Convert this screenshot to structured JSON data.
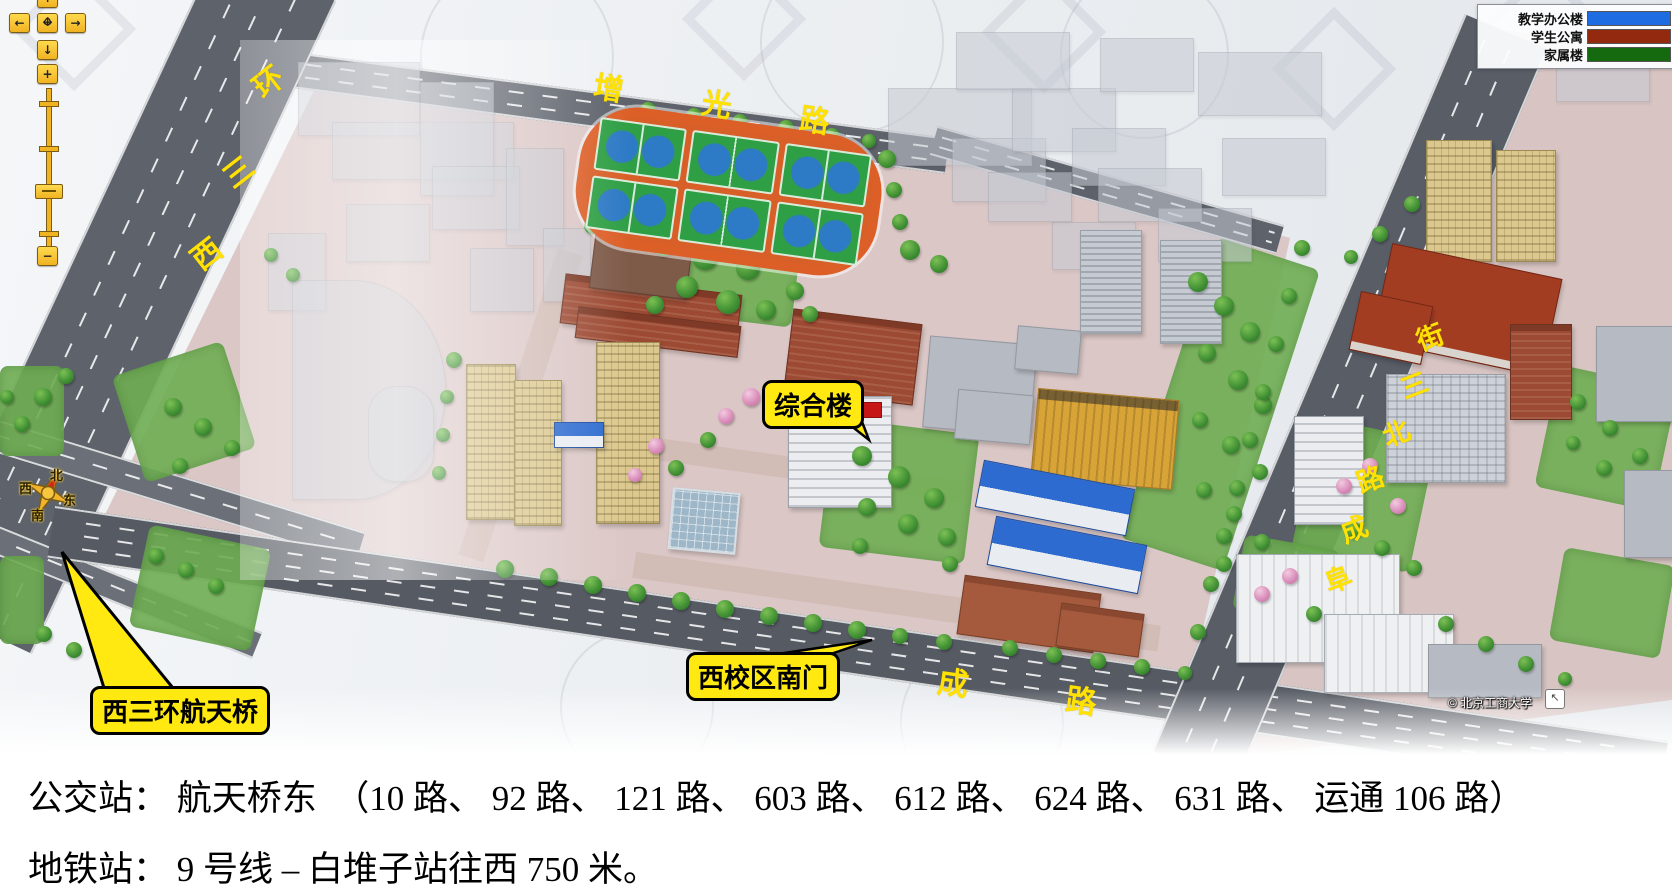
{
  "legend": {
    "items": [
      {
        "label": "教学办公楼",
        "color": "#1d6ce2"
      },
      {
        "label": "学生公寓",
        "color": "#93290e"
      },
      {
        "label": "家属楼",
        "color": "#15690f"
      }
    ]
  },
  "nav": {
    "pan_up": "↑",
    "pan_down": "↓",
    "pan_left": "←",
    "pan_right": "→",
    "pan_h": "↔",
    "pan_v": "↕",
    "zoom_in": "+",
    "zoom_out": "−"
  },
  "compass": {
    "north": "北",
    "south": "南",
    "west": "西",
    "east": "东"
  },
  "callouts": {
    "building": "综合楼",
    "south_gate": "西校区南门",
    "bridge": "西三环航天桥"
  },
  "roads": {
    "zengguang": {
      "name": "增光路",
      "chars": [
        "增",
        "光",
        "路"
      ]
    },
    "xisanhuan": {
      "name": "西三环",
      "chars": [
        "环",
        "三",
        "西"
      ]
    },
    "fucheng_north": {
      "name": "阜成路北三街",
      "chars": [
        "街",
        "三",
        "北",
        "路",
        "成",
        "阜"
      ]
    },
    "fucheng": {
      "name": "阜成路",
      "chars": [
        "阜",
        "成",
        "路"
      ]
    }
  },
  "map": {
    "copyright": "© 北京工商大学",
    "corner_icon": "↖"
  },
  "info": {
    "line1": "公交站： 航天桥东　（10 路、 92 路、 121 路、 603 路、 612 路、 624 路、 631 路、 运通 106 路）",
    "line2": "地铁站： 9 号线 – 白堆子站往西 750 米。"
  }
}
